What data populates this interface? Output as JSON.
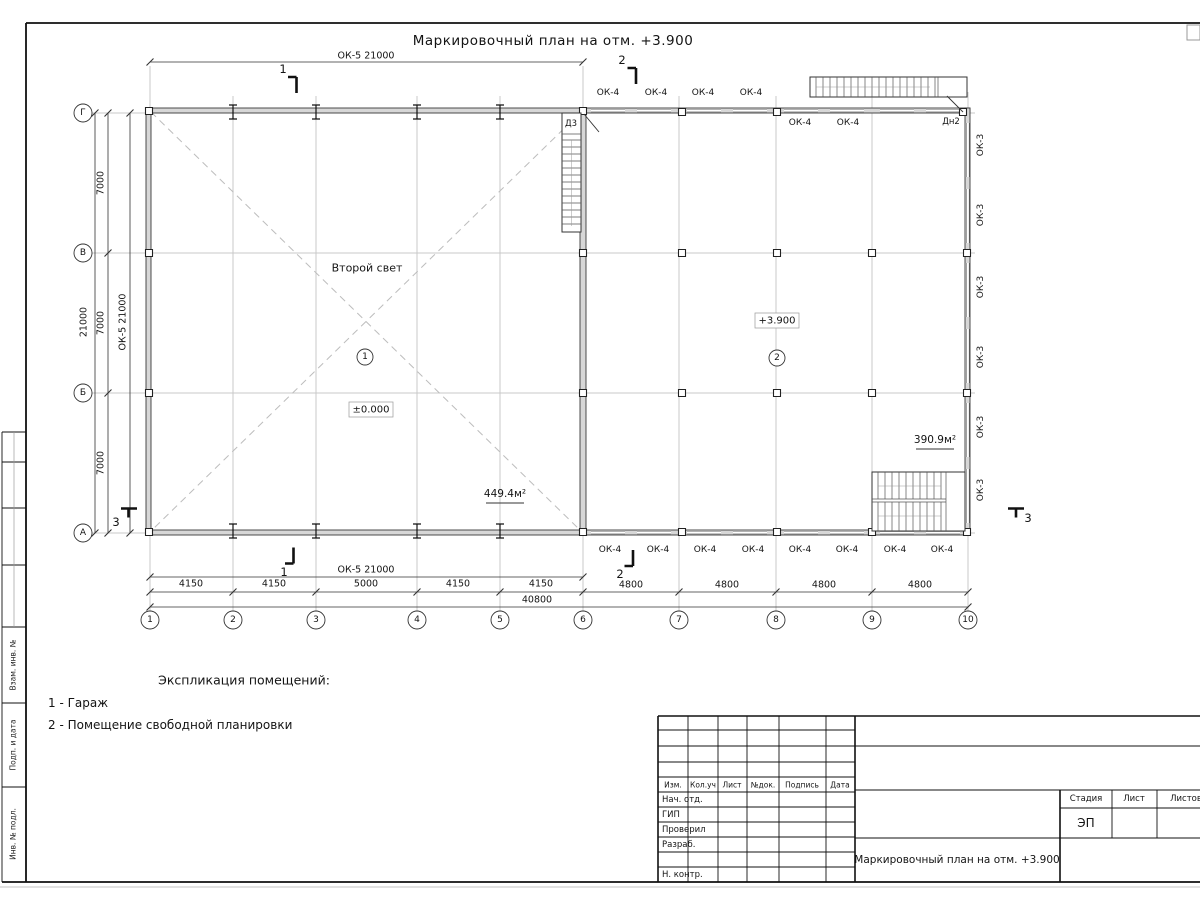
{
  "sheet": {
    "title": "Маркировочный план на отм. +3.900",
    "explication": {
      "heading": "Экспликация помещений:",
      "items": [
        "1 - Гараж",
        "2 - Помещение свободной планировки"
      ]
    },
    "margin_labels": [
      "Взам. инв. №",
      "Подп. и дата",
      "Инв. № подл."
    ]
  },
  "stamp": {
    "headers": {
      "izm": "Изм.",
      "koluch": "Кол.уч",
      "list": "Лист",
      "ndok": "№док.",
      "podpis": "Подпись",
      "data": "Дата"
    },
    "rows": {
      "nach_otd": "Нач. отд.",
      "gip": "ГИП",
      "proveril": "Проверил",
      "razrab": "Разраб.",
      "n_kontr": "Н. контр."
    },
    "right": {
      "stadia": "Стадия",
      "list": "Лист",
      "listov": "Листов",
      "stadia_value": "ЭП"
    },
    "doc_title": "Маркировочный план на отм. +3.900"
  },
  "plan_labels": [
    {
      "t": "ОК-5 21000",
      "x": 366,
      "y": 56,
      "c": "dim",
      "n": "dim-ok5-top"
    },
    {
      "t": "ОК-5 21000",
      "x": 366,
      "y": 570,
      "c": "dim",
      "n": "dim-ok5-bottom"
    },
    {
      "t": "4150",
      "x": 191,
      "y": 584,
      "c": "dim",
      "n": "dim-label"
    },
    {
      "t": "4150",
      "x": 274,
      "y": 584,
      "c": "dim",
      "n": "dim-label"
    },
    {
      "t": "5000",
      "x": 366,
      "y": 584,
      "c": "dim",
      "n": "dim-label"
    },
    {
      "t": "4150",
      "x": 458,
      "y": 584,
      "c": "dim",
      "n": "dim-label"
    },
    {
      "t": "4150",
      "x": 541,
      "y": 584,
      "c": "dim",
      "n": "dim-label"
    },
    {
      "t": "4800",
      "x": 631,
      "y": 585,
      "c": "dim",
      "n": "dim-label"
    },
    {
      "t": "4800",
      "x": 727,
      "y": 585,
      "c": "dim",
      "n": "dim-label"
    },
    {
      "t": "4800",
      "x": 824,
      "y": 585,
      "c": "dim",
      "n": "dim-label"
    },
    {
      "t": "4800",
      "x": 920,
      "y": 585,
      "c": "dim",
      "n": "dim-label"
    },
    {
      "t": "40800",
      "x": 537,
      "y": 600,
      "c": "dim",
      "n": "dim-total"
    },
    {
      "t": "7000",
      "x": 101,
      "y": 183,
      "c": "dimv",
      "n": "dim-label"
    },
    {
      "t": "7000",
      "x": 101,
      "y": 323,
      "c": "dimv",
      "n": "dim-label"
    },
    {
      "t": "7000",
      "x": 101,
      "y": 463,
      "c": "dimv",
      "n": "dim-label"
    },
    {
      "t": "21000",
      "x": 84,
      "y": 322,
      "c": "dimv",
      "n": "dim-total-left"
    },
    {
      "t": "ОК-5 21000",
      "x": 123,
      "y": 322,
      "c": "dimv",
      "n": "dim-ok5-left"
    },
    {
      "t": "ОК-4",
      "x": 608,
      "y": 93,
      "c": "mark",
      "n": "window-mark-ok4"
    },
    {
      "t": "ОК-4",
      "x": 656,
      "y": 93,
      "c": "mark",
      "n": "window-mark-ok4"
    },
    {
      "t": "ОК-4",
      "x": 703,
      "y": 93,
      "c": "mark",
      "n": "window-mark-ok4"
    },
    {
      "t": "ОК-4",
      "x": 751,
      "y": 93,
      "c": "mark",
      "n": "window-mark-ok4"
    },
    {
      "t": "ОК-4",
      "x": 800,
      "y": 123,
      "c": "mark",
      "n": "window-mark-ok4"
    },
    {
      "t": "ОК-4",
      "x": 848,
      "y": 123,
      "c": "mark",
      "n": "window-mark-ok4"
    },
    {
      "t": "ОК-4",
      "x": 610,
      "y": 550,
      "c": "mark",
      "n": "window-mark-ok4"
    },
    {
      "t": "ОК-4",
      "x": 658,
      "y": 550,
      "c": "mark",
      "n": "window-mark-ok4"
    },
    {
      "t": "ОК-4",
      "x": 705,
      "y": 550,
      "c": "mark",
      "n": "window-mark-ok4"
    },
    {
      "t": "ОК-4",
      "x": 753,
      "y": 550,
      "c": "mark",
      "n": "window-mark-ok4"
    },
    {
      "t": "ОК-4",
      "x": 800,
      "y": 550,
      "c": "mark",
      "n": "window-mark-ok4"
    },
    {
      "t": "ОК-4",
      "x": 847,
      "y": 550,
      "c": "mark",
      "n": "window-mark-ok4"
    },
    {
      "t": "ОК-4",
      "x": 895,
      "y": 550,
      "c": "mark",
      "n": "window-mark-ok4"
    },
    {
      "t": "ОК-4",
      "x": 942,
      "y": 550,
      "c": "mark",
      "n": "window-mark-ok4"
    },
    {
      "t": "ОК-3",
      "x": 981,
      "y": 145,
      "c": "markv",
      "n": "window-mark-ok3"
    },
    {
      "t": "ОК-3",
      "x": 981,
      "y": 215,
      "c": "markv",
      "n": "window-mark-ok3"
    },
    {
      "t": "ОК-3",
      "x": 981,
      "y": 287,
      "c": "markv",
      "n": "window-mark-ok3"
    },
    {
      "t": "ОК-3",
      "x": 981,
      "y": 357,
      "c": "markv",
      "n": "window-mark-ok3"
    },
    {
      "t": "ОК-3",
      "x": 981,
      "y": 427,
      "c": "markv",
      "n": "window-mark-ok3"
    },
    {
      "t": "ОК-3",
      "x": 981,
      "y": 490,
      "c": "markv",
      "n": "window-mark-ok3"
    },
    {
      "t": "Дн2",
      "x": 951,
      "y": 122,
      "c": "door",
      "n": "door-mark-dn2"
    },
    {
      "t": "Д3",
      "x": 571,
      "y": 124,
      "c": "door",
      "n": "door-mark-d3"
    },
    {
      "t": "Второй свет",
      "x": 367,
      "y": 268,
      "c": "room",
      "n": "room-note-second-light"
    },
    {
      "t": "1",
      "x": 365,
      "y": 357,
      "c": "bub",
      "n": "room-number-1"
    },
    {
      "t": "2",
      "x": 777,
      "y": 358,
      "c": "bub",
      "n": "room-number-2"
    },
    {
      "t": "±0.000",
      "x": 371,
      "y": 410,
      "c": "elev",
      "n": "elevation-mark-0000"
    },
    {
      "t": "+3.900",
      "x": 777,
      "y": 321,
      "c": "elev",
      "n": "elevation-mark-3900"
    },
    {
      "t": "449.4м²",
      "x": 505,
      "y": 494,
      "c": "area",
      "n": "room-area-1"
    },
    {
      "t": "390.9м²",
      "x": 935,
      "y": 440,
      "c": "area",
      "n": "room-area-2"
    },
    {
      "t": "1",
      "x": 283,
      "y": 69,
      "c": "sec",
      "n": "section-mark-1-top"
    },
    {
      "t": "2",
      "x": 622,
      "y": 60,
      "c": "sec",
      "n": "section-mark-2-top"
    },
    {
      "t": "1",
      "x": 284,
      "y": 572,
      "c": "sec",
      "n": "section-mark-1-bottom"
    },
    {
      "t": "2",
      "x": 620,
      "y": 574,
      "c": "sec",
      "n": "section-mark-2-bottom"
    },
    {
      "t": "3",
      "x": 116,
      "y": 522,
      "c": "sec",
      "n": "section-mark-3-left"
    },
    {
      "t": "3",
      "x": 1028,
      "y": 518,
      "c": "sec",
      "n": "section-mark-3-right"
    },
    {
      "t": "1",
      "x": 150,
      "y": 620,
      "c": "bub",
      "n": "grid-axis-1"
    },
    {
      "t": "2",
      "x": 233,
      "y": 620,
      "c": "bub",
      "n": "grid-axis-2"
    },
    {
      "t": "3",
      "x": 316,
      "y": 620,
      "c": "bub",
      "n": "grid-axis-3"
    },
    {
      "t": "4",
      "x": 417,
      "y": 620,
      "c": "bub",
      "n": "grid-axis-4"
    },
    {
      "t": "5",
      "x": 500,
      "y": 620,
      "c": "bub",
      "n": "grid-axis-5"
    },
    {
      "t": "6",
      "x": 583,
      "y": 620,
      "c": "bub",
      "n": "grid-axis-6"
    },
    {
      "t": "7",
      "x": 679,
      "y": 620,
      "c": "bub",
      "n": "grid-axis-7"
    },
    {
      "t": "8",
      "x": 776,
      "y": 620,
      "c": "bub",
      "n": "grid-axis-8"
    },
    {
      "t": "9",
      "x": 872,
      "y": 620,
      "c": "bub",
      "n": "grid-axis-9"
    },
    {
      "t": "10",
      "x": 968,
      "y": 620,
      "c": "bub",
      "n": "grid-axis-10"
    },
    {
      "t": "Г",
      "x": 83,
      "y": 113,
      "c": "bub",
      "n": "grid-axis-g"
    },
    {
      "t": "В",
      "x": 83,
      "y": 253,
      "c": "bub",
      "n": "grid-axis-v"
    },
    {
      "t": "Б",
      "x": 83,
      "y": 393,
      "c": "bub",
      "n": "grid-axis-b"
    },
    {
      "t": "А",
      "x": 83,
      "y": 533,
      "c": "bub",
      "n": "grid-axis-a"
    }
  ]
}
